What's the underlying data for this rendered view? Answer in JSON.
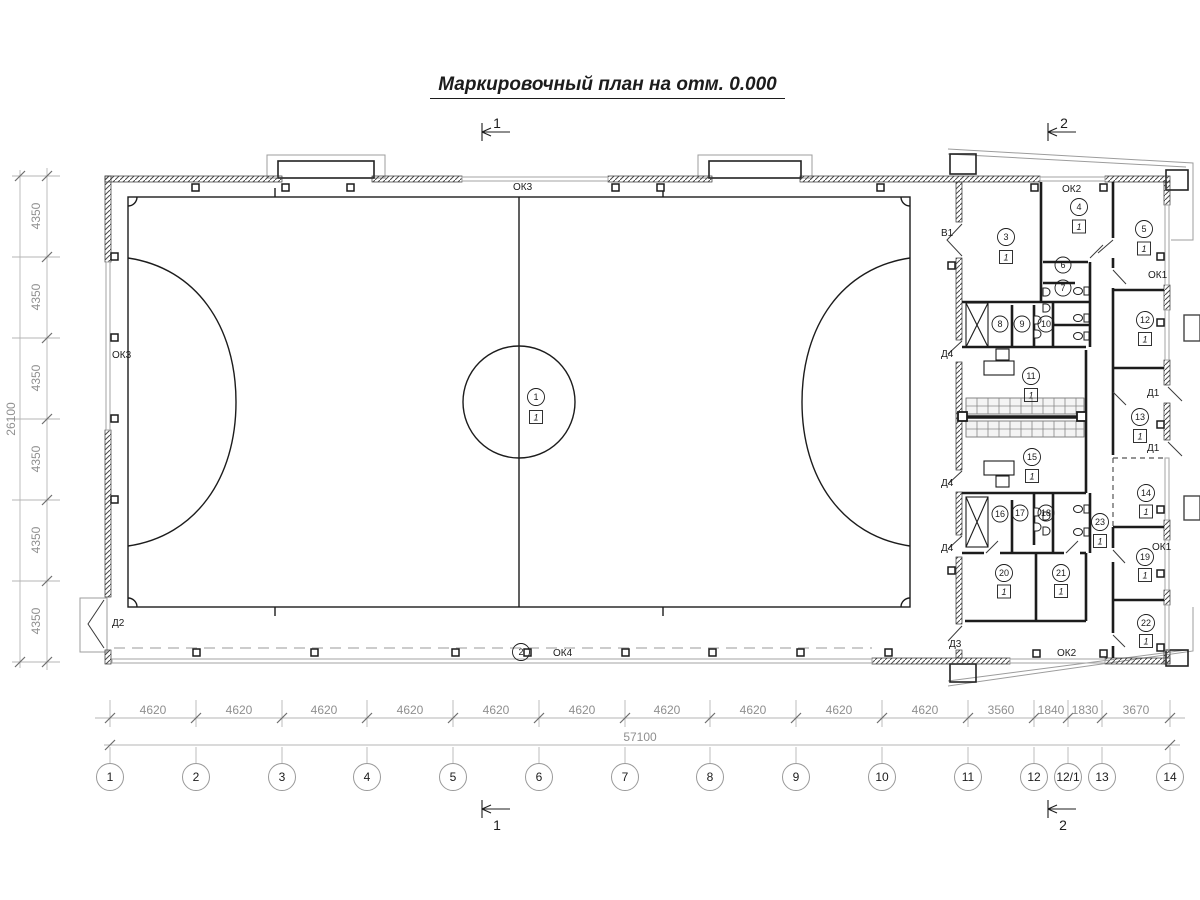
{
  "title": "Маркировочный план на отм. 0.000",
  "section_marks": {
    "top_left": "1",
    "top_right": "2",
    "bottom_left": "1",
    "bottom_right": "2"
  },
  "grid": {
    "columns": [
      "1",
      "2",
      "3",
      "4",
      "5",
      "6",
      "7",
      "8",
      "9",
      "10",
      "11",
      "12",
      "12/1",
      "13",
      "14"
    ],
    "col_dims": [
      "4620",
      "4620",
      "4620",
      "4620",
      "4620",
      "4620",
      "4620",
      "4620",
      "4620",
      "4620",
      "3560",
      "1840",
      "1830",
      "3670"
    ],
    "total_width": "57100",
    "row_dims": [
      "4350",
      "4350",
      "4350",
      "4350",
      "4350",
      "4350"
    ],
    "total_height": "26100"
  },
  "rooms": [
    {
      "n": "1",
      "f": "1"
    },
    {
      "n": "2"
    },
    {
      "n": "3",
      "f": "1"
    },
    {
      "n": "4",
      "f": "1"
    },
    {
      "n": "5",
      "f": "1"
    },
    {
      "n": "6"
    },
    {
      "n": "7"
    },
    {
      "n": "8"
    },
    {
      "n": "9"
    },
    {
      "n": "10"
    },
    {
      "n": "11",
      "f": "1"
    },
    {
      "n": "12",
      "f": "1"
    },
    {
      "n": "13",
      "f": "1"
    },
    {
      "n": "14",
      "f": "1"
    },
    {
      "n": "15",
      "f": "1"
    },
    {
      "n": "16"
    },
    {
      "n": "17"
    },
    {
      "n": "18"
    },
    {
      "n": "19",
      "f": "1"
    },
    {
      "n": "20",
      "f": "1"
    },
    {
      "n": "21",
      "f": "1"
    },
    {
      "n": "22",
      "f": "1"
    },
    {
      "n": "23",
      "f": "1"
    }
  ],
  "openings": {
    "ok3_top": "ОК3",
    "ok3_left": "ОК3",
    "ok4_bottom": "ОК4",
    "ok2_top": "ОК2",
    "ok2_bottom": "ОК2",
    "ok1_right_top": "ОК1",
    "ok1_right_bottom": "ОК1",
    "v1": "В1",
    "d1_top": "Д1",
    "d1_bottom": "Д1",
    "d2": "Д2",
    "d3": "Д3",
    "d4_top": "Д4",
    "d4_mid": "Д4",
    "d4_bottom": "Д4"
  },
  "colors": {
    "line": "#1c1c1c",
    "dim": "#8f8f8f",
    "window": "#aaaaaa",
    "background": "#ffffff"
  }
}
